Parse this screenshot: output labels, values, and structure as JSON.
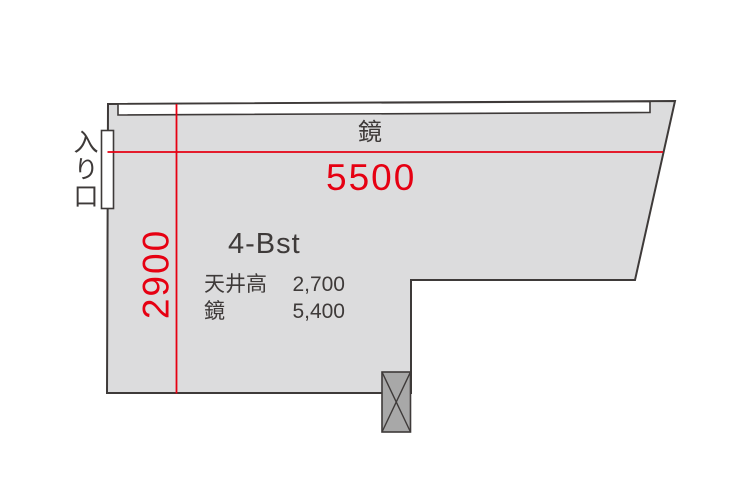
{
  "plan": {
    "room_name": "4-Bst",
    "mirror_label": "鏡",
    "entrance_label": "入り口",
    "dimensions": {
      "width_mm": "5500",
      "depth_mm": "2900"
    },
    "specs": [
      {
        "label": "天井高",
        "value": "2,700"
      },
      {
        "label": "鏡",
        "value": "5,400"
      }
    ],
    "colors": {
      "dimension_red": "#e60012",
      "room_fill": "#dcdcdd",
      "wall_stroke": "#3e3a39",
      "pillar_fill": "#a8a8a8",
      "mirror_fill": "#ffffff",
      "door_fill": "#ffffff"
    }
  }
}
